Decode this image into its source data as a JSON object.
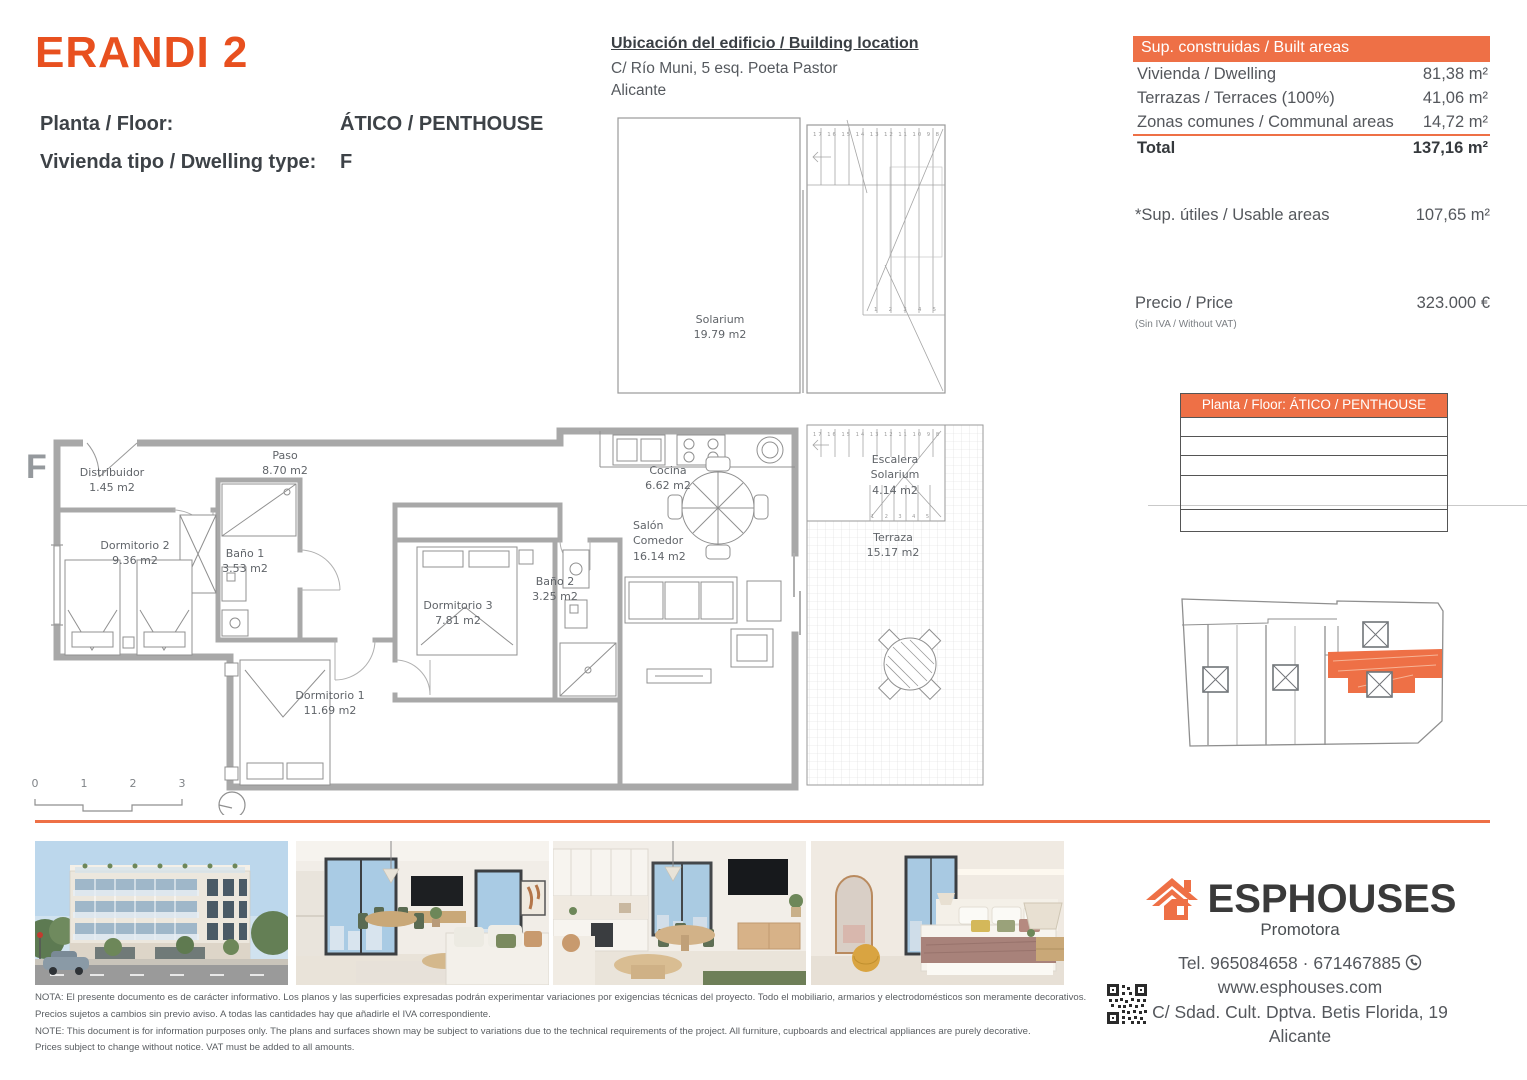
{
  "header": {
    "brand": "ERANDI 2",
    "floor_label": "Planta / Floor:",
    "floor_value": "ÁTICO / PENTHOUSE",
    "type_label": "Vivienda tipo / Dwelling type:",
    "type_value": "F"
  },
  "location": {
    "title": "Ubicación del edificio / Building location",
    "address": "C/ Río Muni, 5 esq. Poeta Pastor",
    "city": "Alicante"
  },
  "built_areas": {
    "header": "Sup. construidas / Built areas",
    "rows": [
      {
        "label": "Vivienda / Dwelling",
        "value": "81,38 m²"
      },
      {
        "label": "Terrazas / Terraces (100%)",
        "value": "41,06 m²"
      },
      {
        "label": "Zonas comunes / Communal areas",
        "value": "14,72 m²"
      }
    ],
    "total_label": "Total",
    "total_value": "137,16 m²",
    "usable_label": "*Sup. útiles / Usable areas",
    "usable_value": "107,65 m²",
    "price_label": "Precio / Price",
    "price_note": "(Sin IVA / Without VAT)",
    "price_value": "323.000 €"
  },
  "floor_table": {
    "header": "Planta / Floor: ÁTICO / PENTHOUSE"
  },
  "plan": {
    "marker": "F",
    "rooms": [
      {
        "name": "Solarium",
        "area": "19.79 m2"
      },
      {
        "name": "Distribuidor",
        "area": "1.45 m2"
      },
      {
        "name": "Paso",
        "area": "8.70 m2"
      },
      {
        "name": "Dormitorio 2",
        "area": "9.36 m2"
      },
      {
        "name": "Baño 1",
        "area": "3.53 m2"
      },
      {
        "name": "Dormitorio 1",
        "area": "11.69 m2"
      },
      {
        "name": "Dormitorio 3",
        "area": "7.81 m2"
      },
      {
        "name": "Baño 2",
        "area": "3.25 m2"
      },
      {
        "name": "Cocina",
        "area": "6.62 m2"
      },
      {
        "name": "Salón Comedor",
        "area": "16.14 m2"
      },
      {
        "name": "Escalera Solarium",
        "area": "4.14 m2"
      },
      {
        "name": "Terraza",
        "area": "15.17 m2"
      }
    ],
    "scale": [
      "0",
      "1",
      "2",
      "3"
    ],
    "stairs_top": "17 16 15 14 13 12 11 10 9 8",
    "stairs_bottom": "1 2 3 4 5"
  },
  "footer": {
    "brand": "ESPHOUSES",
    "tagline": "Promotora",
    "tel": "Tel. 965084658 · 671467885",
    "web": "www.esphouses.com",
    "address": "C/ Sdad. Cult. Dptva. Betis Florida, 19",
    "city": "Alicante"
  },
  "disclaimer": {
    "line1": "NOTA: El presente documento es de carácter informativo. Los planos y las superficies expresadas podrán experimentar variaciones por exigencias técnicas del proyecto. Todo el mobiliario, armarios y electrodomésticos son meramente decorativos.",
    "line2": "Precios sujetos a cambios sin previo aviso. A todas las cantidades hay que añadirle el IVA correspondiente.",
    "line3": "NOTE: This document is for information purposes only. The plans and surfaces shown may be subject to variations due to the technical requirements of the project. All furniture, cupboards and electrical appliances are purely decorative.",
    "line4": "Prices subject to change without notice. VAT must be added to all amounts."
  },
  "colors": {
    "accent": "#ee7046",
    "brand": "#e8501f"
  }
}
